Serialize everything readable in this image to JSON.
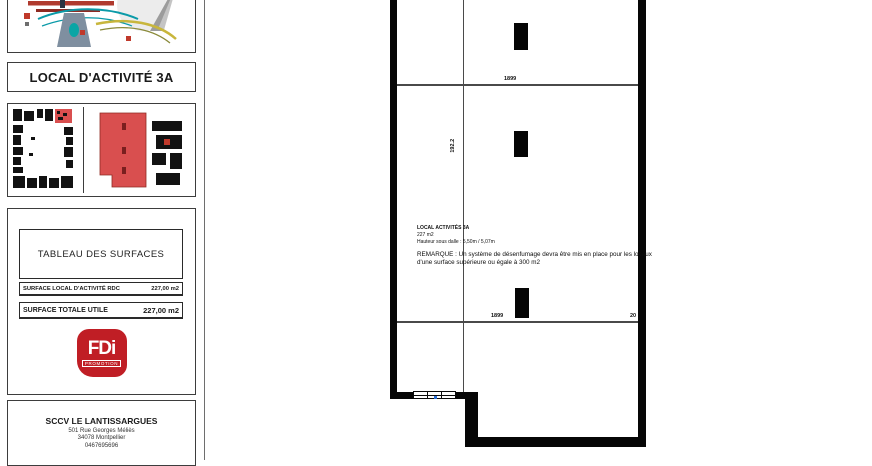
{
  "title_block": {
    "logo_text": "Modernes",
    "project_title": "LOCAL D'ACTIVITÉ 3A",
    "surface_table": {
      "title": "TABLEAU DES SURFACES",
      "rows": [
        {
          "label": "SURFACE LOCAL D'ACTIVITÉ RDC",
          "value": "227,00 m2"
        },
        {
          "label": "SURFACE TOTALE UTILE",
          "value": "227,00 m2"
        }
      ]
    },
    "promoter_logo": {
      "text": "FDi",
      "subtitle": "PROMOTION",
      "color": "#c01e25"
    },
    "company": {
      "name": "SCCV LE LANTISSARGUES",
      "address_line1": "501 Rue Georges Méliès",
      "address_line2": "34078 Montpellier",
      "phone": "0467695696"
    }
  },
  "plan": {
    "room": {
      "name": "LOCAL ACTIVITÉS 3A",
      "area": "227 m2",
      "height_note": "Hauteur sous dalle : 5,50m / 5,07m"
    },
    "remark": {
      "line1": "REMARQUE : Un système de désenfumage devra être mis en place pour les locaux",
      "line2": "d'une surface supérieure ou égale  à 300 m2"
    },
    "dimensions": {
      "top_bay": "1899",
      "left_vertical": "192.2",
      "bottom_bay": "1899",
      "bottom_right": "20"
    },
    "highlight_color": "#d94f4f",
    "wall_color": "#060606"
  }
}
